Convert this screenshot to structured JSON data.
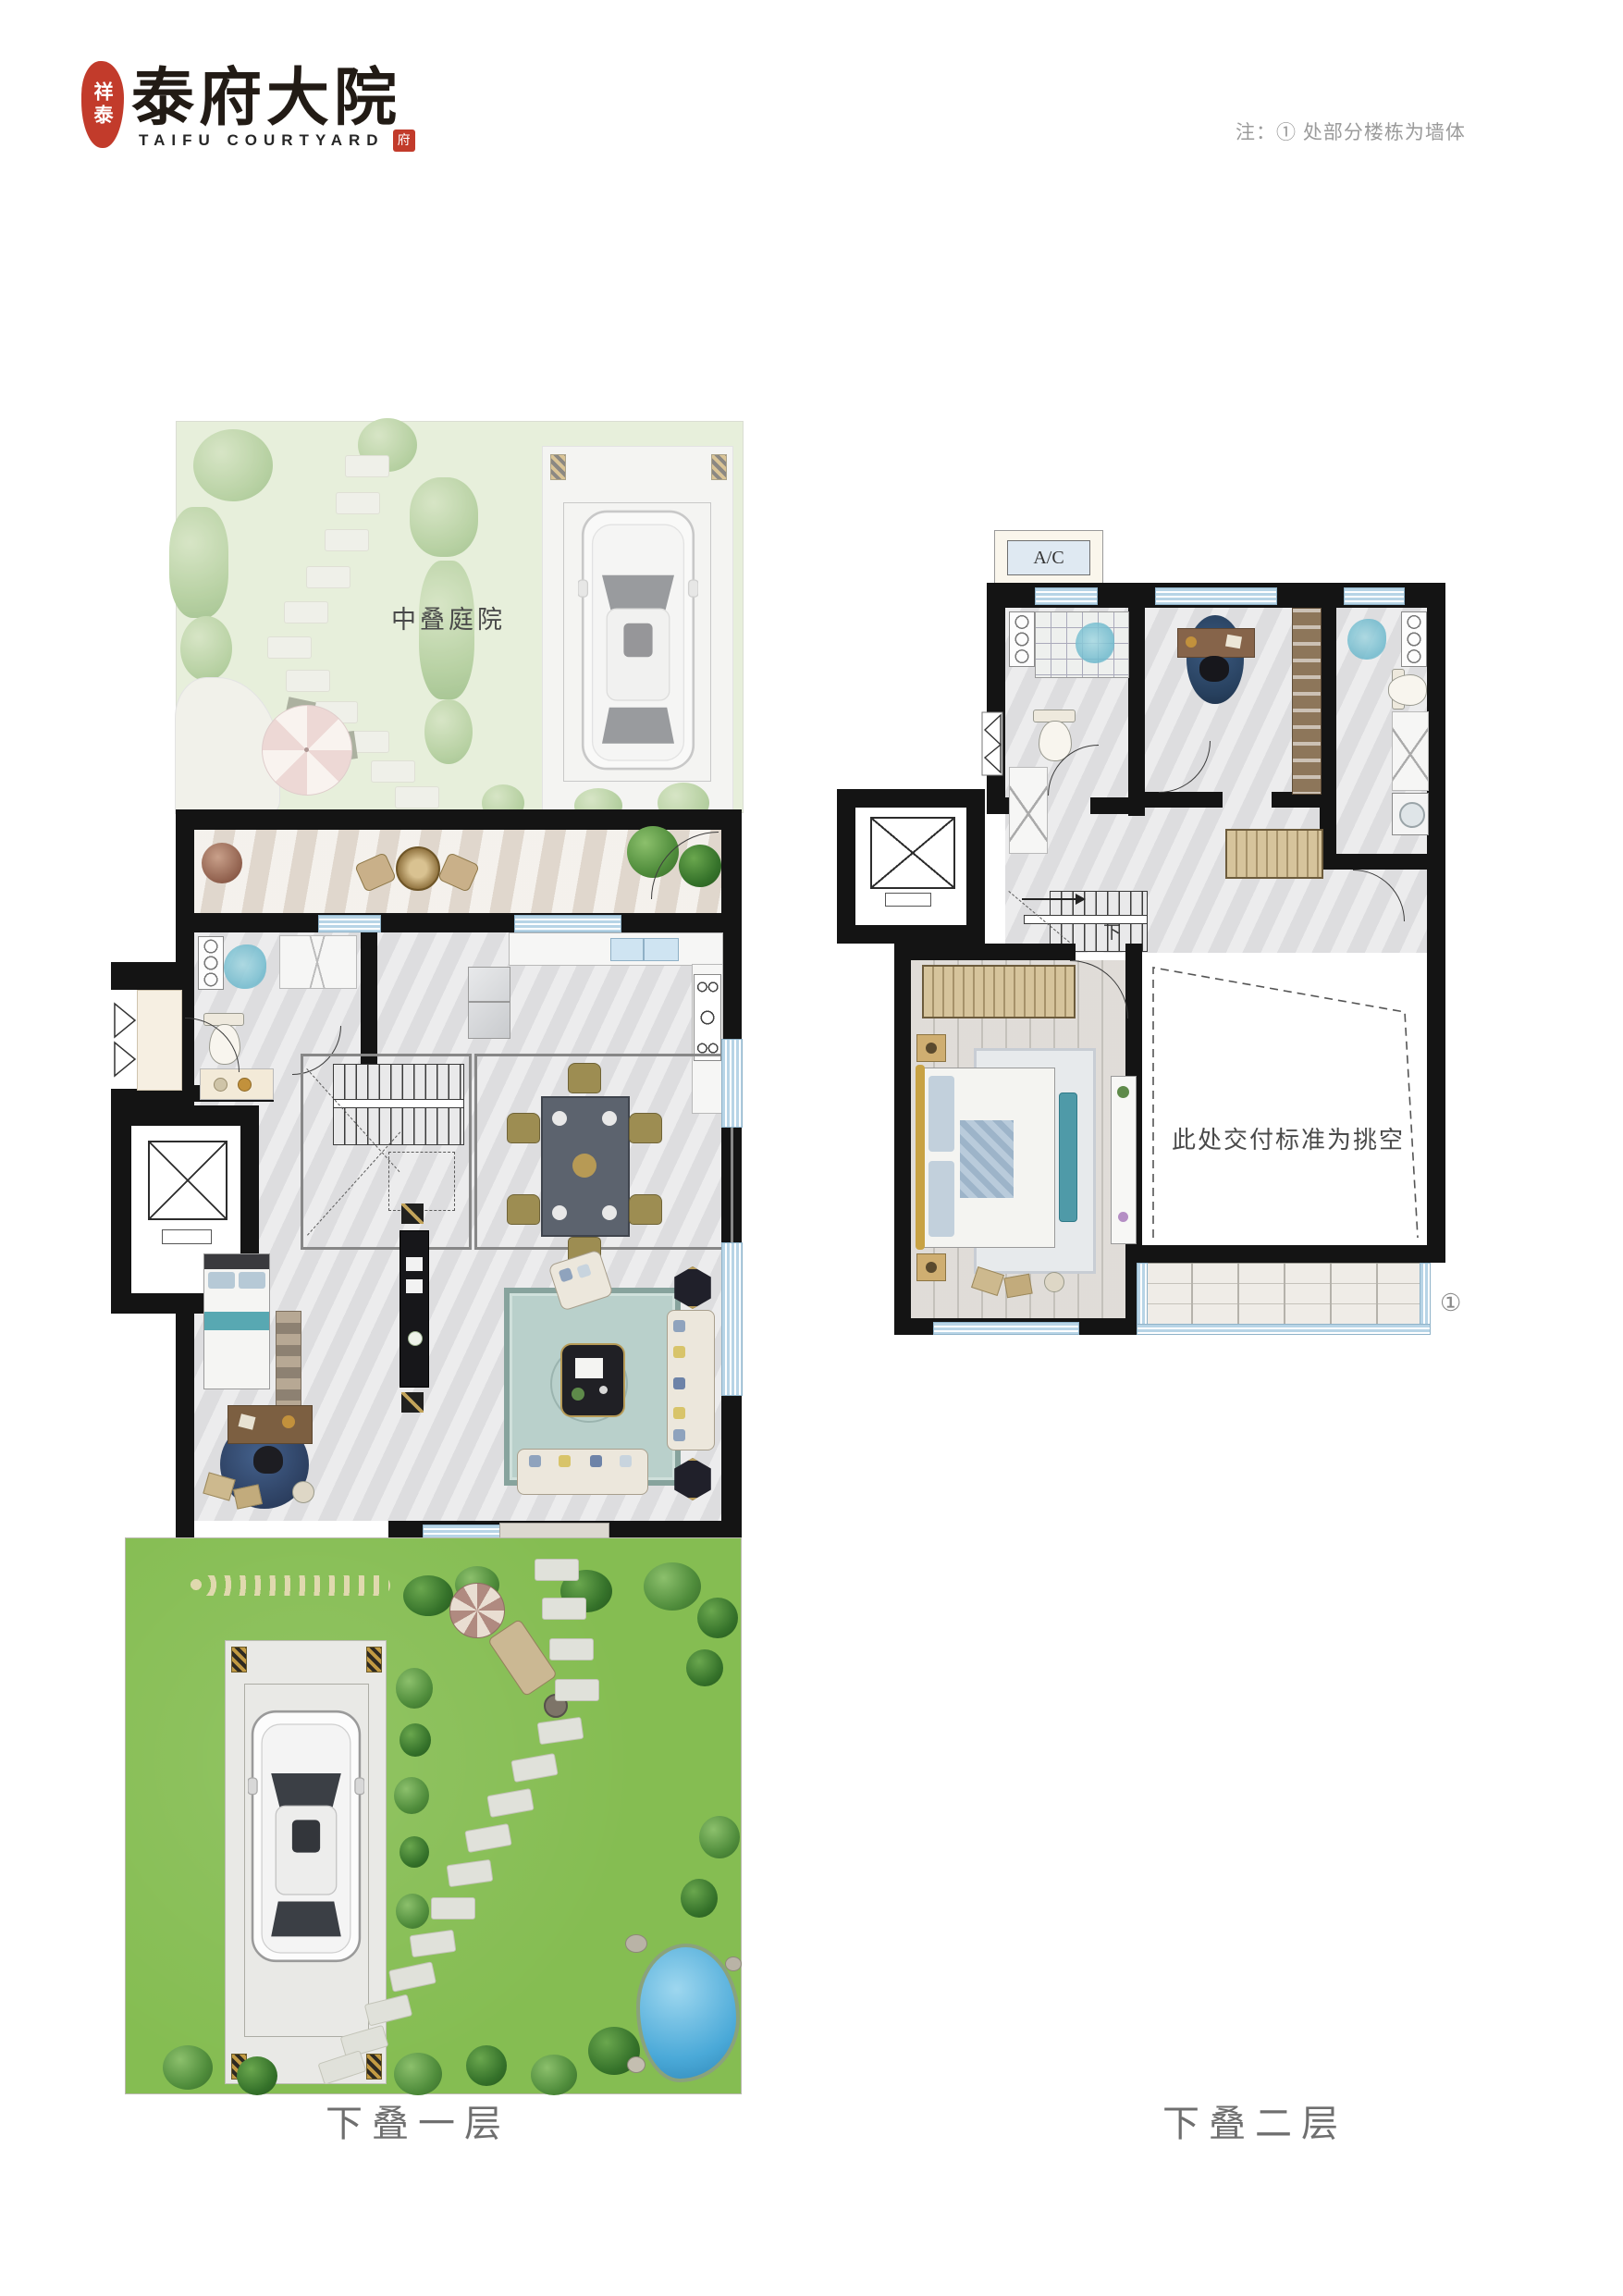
{
  "header": {
    "seal_text": "祥泰",
    "title": "泰府大院",
    "subtitle": "TAIFU COURTYARD",
    "subtitle_seal": "府",
    "note": "注：① 处部分楼栋为墙体"
  },
  "plans": {
    "level1": {
      "caption": "下叠一层",
      "courtyard_label": "中叠庭院"
    },
    "level2": {
      "caption": "下叠二层",
      "ac_label": "A/C",
      "void_label": "此处交付标准为挑空",
      "stairs_down_label": "下",
      "wall_marker": "①"
    }
  },
  "theme": {
    "brand_red": "#c23b2b",
    "ink_black": "#221b15",
    "wall_black": "#141414",
    "note_gray": "#9b9b9b",
    "caption_gray": "#6f6f6f",
    "window_blue": "#b7d4e6",
    "floor_gray": "#e2e2e4",
    "wood_gray": "#d5d1cb",
    "garden_green": "#85bd52",
    "courtyard_faded": "#e2ecd4",
    "pond_blue": "#4aa9d8",
    "rug_teal": "#b9d0cb"
  }
}
